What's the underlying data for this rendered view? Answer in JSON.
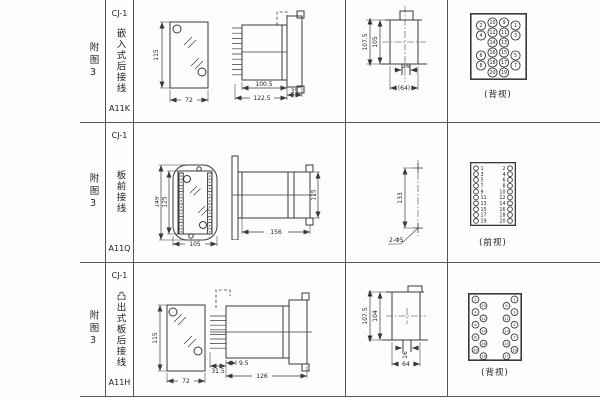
{
  "colors": {
    "line": "#3a3a3a",
    "text": "#1f1f1f",
    "background": "#fdfdfd"
  },
  "rows": [
    {
      "fig": "附图3",
      "model": "CJ-1",
      "mount": "嵌入式后接线",
      "code": "A11K",
      "front": {
        "h": "115",
        "w": "72"
      },
      "side": {
        "d1": "100.5",
        "d2": "122.5",
        "d3": "35"
      },
      "cutout": {
        "v1": "107.5",
        "v2": "105",
        "h1": "16",
        "h2": "(64)"
      },
      "terminal": {
        "caption": "(背视)"
      }
    },
    {
      "fig": "附图3",
      "model": "CJ-1",
      "mount": "板前接线",
      "code": "A11Q",
      "front": {
        "v1": "149",
        "v2": "125",
        "w": "105"
      },
      "side": {
        "w": "156",
        "h": "115"
      },
      "holes": {
        "dist": "133",
        "label": "2-Φ5"
      },
      "terminal": {
        "caption": "(前视)"
      }
    },
    {
      "fig": "附图3",
      "model": "CJ-1",
      "mount": "凸出式板后接线",
      "code": "A11H",
      "front": {
        "h": "115",
        "w": "72"
      },
      "side": {
        "d1": "31.5",
        "d2": "9.5",
        "d3": "126"
      },
      "cutout": {
        "v1": "107.5",
        "v2": "104",
        "h1": "16",
        "h2": "64"
      },
      "terminal": {
        "caption": "(背视)"
      }
    }
  ],
  "terminals": {
    "back20": {
      "w": 57,
      "h": 67,
      "r": 4.6,
      "fs": 4.8,
      "bw": 1.6,
      "cells": [
        {
          "x": 22.5,
          "y": 9.5,
          "n": "10"
        },
        {
          "x": 34,
          "y": 9.5,
          "n": "9"
        },
        {
          "x": 11,
          "y": 12.5,
          "n": "2"
        },
        {
          "x": 45.5,
          "y": 12.5,
          "n": "1"
        },
        {
          "x": 22.5,
          "y": 19.5,
          "n": "12"
        },
        {
          "x": 34,
          "y": 19.5,
          "n": "11"
        },
        {
          "x": 11,
          "y": 22.5,
          "n": "4"
        },
        {
          "x": 45.5,
          "y": 22.5,
          "n": "3"
        },
        {
          "x": 22.5,
          "y": 29.5,
          "n": "14"
        },
        {
          "x": 34,
          "y": 29.5,
          "n": "13"
        },
        {
          "x": 22.5,
          "y": 39.5,
          "n": "16"
        },
        {
          "x": 34,
          "y": 39.5,
          "n": "15"
        },
        {
          "x": 11,
          "y": 42.5,
          "n": "6"
        },
        {
          "x": 45.5,
          "y": 42.5,
          "n": "5"
        },
        {
          "x": 22.5,
          "y": 49.5,
          "n": "18"
        },
        {
          "x": 34,
          "y": 49.5,
          "n": "17"
        },
        {
          "x": 11,
          "y": 52.5,
          "n": "8"
        },
        {
          "x": 45.5,
          "y": 52.5,
          "n": "7"
        },
        {
          "x": 22.5,
          "y": 59.5,
          "n": "20"
        },
        {
          "x": 34,
          "y": 59.5,
          "n": "19"
        }
      ]
    },
    "front20": {
      "w": 46,
      "h": 64,
      "r": 2.4,
      "fs": 4.8,
      "bw": 1.3,
      "cells": [
        {
          "x": 6,
          "y": 6.2,
          "n": "1",
          "tx": 10.5,
          "a": "start"
        },
        {
          "x": 40,
          "y": 6.2,
          "n": "2",
          "tx": 35.5,
          "a": "end"
        },
        {
          "x": 6,
          "y": 12.1,
          "n": "3",
          "tx": 10.5,
          "a": "start"
        },
        {
          "x": 40,
          "y": 12.1,
          "n": "4",
          "tx": 35.5,
          "a": "end"
        },
        {
          "x": 6,
          "y": 17.9,
          "n": "5",
          "tx": 10.5,
          "a": "start"
        },
        {
          "x": 40,
          "y": 17.9,
          "n": "6",
          "tx": 35.5,
          "a": "end"
        },
        {
          "x": 6,
          "y": 23.8,
          "n": "7",
          "tx": 10.5,
          "a": "start"
        },
        {
          "x": 40,
          "y": 23.8,
          "n": "8",
          "tx": 35.5,
          "a": "end"
        },
        {
          "x": 6,
          "y": 29.6,
          "n": "9",
          "tx": 10.5,
          "a": "start"
        },
        {
          "x": 40,
          "y": 29.6,
          "n": "10",
          "tx": 35.5,
          "a": "end"
        },
        {
          "x": 6,
          "y": 35.5,
          "n": "11",
          "tx": 10.5,
          "a": "start"
        },
        {
          "x": 40,
          "y": 35.5,
          "n": "12",
          "tx": 35.5,
          "a": "end"
        },
        {
          "x": 6,
          "y": 41.3,
          "n": "13",
          "tx": 10.5,
          "a": "start"
        },
        {
          "x": 40,
          "y": 41.3,
          "n": "14",
          "tx": 35.5,
          "a": "end"
        },
        {
          "x": 6,
          "y": 47.2,
          "n": "15",
          "tx": 10.5,
          "a": "start"
        },
        {
          "x": 40,
          "y": 47.2,
          "n": "16",
          "tx": 35.5,
          "a": "end"
        },
        {
          "x": 6,
          "y": 53,
          "n": "17",
          "tx": 10.5,
          "a": "start"
        },
        {
          "x": 40,
          "y": 53,
          "n": "18",
          "tx": 35.5,
          "a": "end"
        },
        {
          "x": 6,
          "y": 58.9,
          "n": "19",
          "tx": 10.5,
          "a": "start"
        },
        {
          "x": 40,
          "y": 58.9,
          "n": "20",
          "tx": 35.5,
          "a": "end"
        }
      ]
    },
    "backZig": {
      "w": 54,
      "h": 68,
      "r": 3.4,
      "fs": 3.8,
      "bw": 1.6,
      "cells": [
        {
          "x": 7.5,
          "y": 6.5,
          "n": "2"
        },
        {
          "x": 15.5,
          "y": 12.8,
          "n": "10"
        },
        {
          "x": 7.5,
          "y": 19.1,
          "n": "4"
        },
        {
          "x": 15.5,
          "y": 25.4,
          "n": "12"
        },
        {
          "x": 7.5,
          "y": 31.7,
          "n": "6"
        },
        {
          "x": 15.5,
          "y": 38,
          "n": "14"
        },
        {
          "x": 7.5,
          "y": 44.3,
          "n": "8"
        },
        {
          "x": 15.5,
          "y": 50.6,
          "n": "16"
        },
        {
          "x": 7.5,
          "y": 56.9,
          "n": "20"
        },
        {
          "x": 15.5,
          "y": 63.2,
          "n": "18"
        },
        {
          "x": 46.5,
          "y": 6.5,
          "n": "1"
        },
        {
          "x": 38.5,
          "y": 12.8,
          "n": "9"
        },
        {
          "x": 46.5,
          "y": 19.1,
          "n": "3"
        },
        {
          "x": 38.5,
          "y": 25.4,
          "n": "11"
        },
        {
          "x": 46.5,
          "y": 31.7,
          "n": "5"
        },
        {
          "x": 38.5,
          "y": 38,
          "n": "13"
        },
        {
          "x": 46.5,
          "y": 44.3,
          "n": "7"
        },
        {
          "x": 38.5,
          "y": 50.6,
          "n": "15"
        },
        {
          "x": 46.5,
          "y": 56.9,
          "n": "19"
        },
        {
          "x": 38.5,
          "y": 63.2,
          "n": "17"
        }
      ]
    }
  }
}
